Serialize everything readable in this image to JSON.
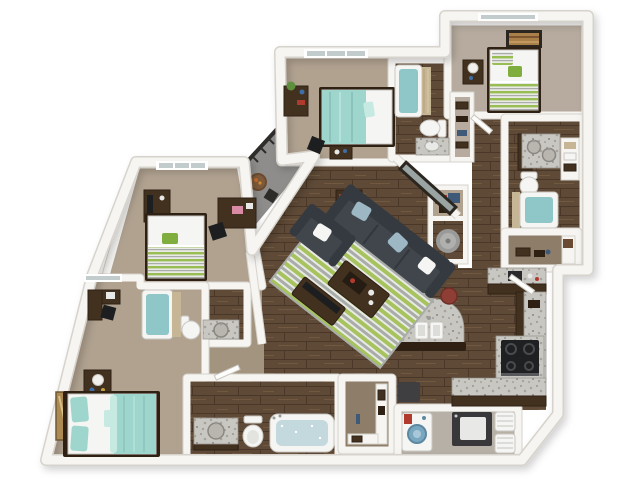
{
  "title": "3D rendered floor plan of a four-bedroom four-bath apartment, top-down view",
  "palette": {
    "wall": "#f6f5f2",
    "wallEdge": "#d7d3cc",
    "carpet": "#b1a290",
    "carpetLight": "#b6aB9e",
    "tanHall": "#a2947f",
    "closetFloor": "#8d7d69",
    "laundryFloor": "#b7b0a6",
    "balconyFloor": "#8e8d8b",
    "railing": "#2f2d2a",
    "wood1": "#5f4a37",
    "wood2": "#4a3727",
    "wood3": "#70593f",
    "furnWood": "#42311f",
    "furnWoodDark": "#2e2114",
    "teal": "#9ed5cc",
    "tealLight": "#c6e9e2",
    "green": "#97bd53",
    "greenDark": "#7fae3f",
    "rugGreen": "#a6c35e",
    "rugGray": "#a8ada9",
    "rugWhite": "#e9e9e5",
    "sofa": "#41464c",
    "sofaDark": "#343a40",
    "pillowBlue": "#9db8c4",
    "granite": "#c9c7c1",
    "graniteSpeck1": "#a5a29b",
    "graniteSpeck2": "#8a8780",
    "graniteEdge": "#9b9790",
    "fixture": "#f5f5f3",
    "fixtureEdge": "#c9c7c2",
    "waterTeal": "#8fc7c9",
    "waterPale": "#c3d9de",
    "curtainTan": "#c6b695",
    "stool": "#8f3e35",
    "stove": "#1f2022",
    "washerBlue": "#7aa7c0",
    "red": "#b03a2e",
    "clothesBlue": "#3e5a78",
    "plant": "#5d8f3c",
    "frameDark": "#2b2620",
    "artGold": "#ac8a52",
    "artCanvas": "#a97f4a",
    "glass": "#c2cccc",
    "metal": "#9a9a98"
  },
  "scene": {
    "balcony": {
      "label": "balcony with railing, bistro table and chair"
    },
    "living_room": {
      "label": "living room with charcoal sofa, armchair, striped rug, coffee table, media console and wall mirror"
    },
    "kitchen": {
      "label": "kitchen with curved granite island, three bar stools, stove and L-shaped counters"
    },
    "bedroom_top_middle": {
      "label": "bedroom with teal bed, dresser with plant and desk chair"
    },
    "bedroom_top_right": {
      "label": "bedroom with green striped bed, nightstand lamp and wall art"
    },
    "bedroom_left": {
      "label": "bedroom with green striped bed, media chest and desk"
    },
    "bedroom_bottom_left": {
      "label": "bedroom with teal bed, nightstand, corner desk and wall art"
    },
    "bathroom_top": {
      "label": "bathroom with tub, toilet and granite vanity"
    },
    "bathroom_right": {
      "label": "bathroom with double granite vanity, toilet, curtained tub and linen shelves"
    },
    "bathroom_mid_left": {
      "label": "bathroom with tub, toilet and granite vanity"
    },
    "bathroom_bottom": {
      "label": "bathroom with granite vanity, toilet and soaking tub"
    },
    "closet_right": {
      "label": "walk-in closet with shelving"
    },
    "closet_bottom": {
      "label": "walk-in closet with shelving"
    },
    "closet_hall": {
      "label": "hall closet with clothes"
    },
    "utility_closet": {
      "label": "utility closet with water heater"
    },
    "laundry_room": {
      "label": "laundry room with washer, dryer and hampers"
    },
    "hallway": {
      "label": "wood-floor hallway"
    }
  }
}
